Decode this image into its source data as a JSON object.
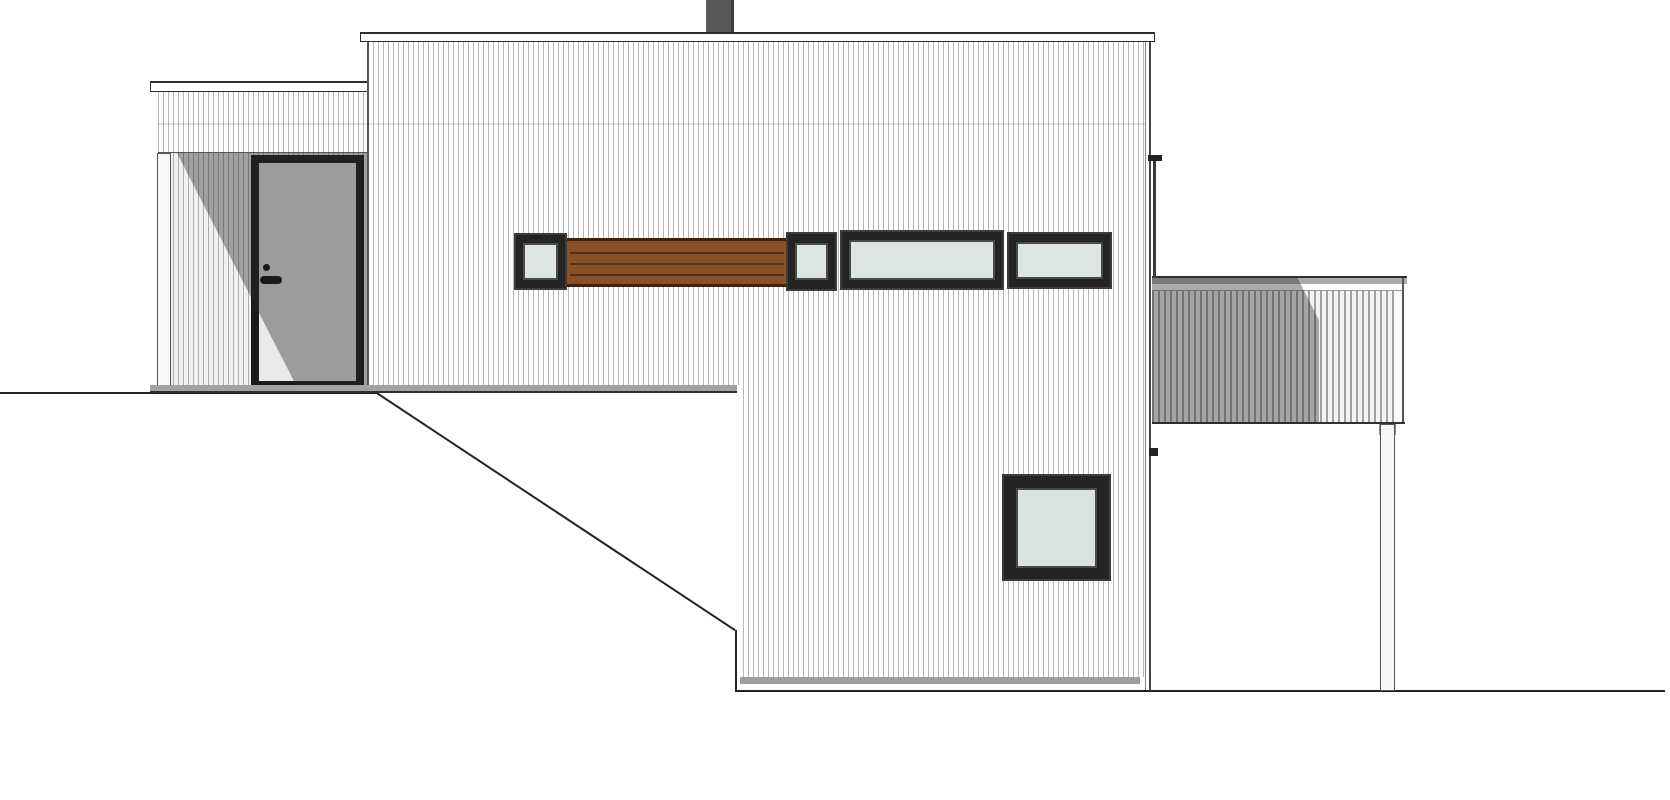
{
  "title": "House side elevation drawing",
  "drawing": {
    "type": "architectural-elevation",
    "view": "side",
    "notes": "split-level house on sloping site; no text or dimensions visible in drawing",
    "colors": {
      "paper": "#ffffff",
      "cladding_white": "#fdfdfd",
      "cladding_stripe": "#b4b4b4",
      "outline_dark": "#222222",
      "frame_black": "#1f1f1f",
      "glass_green": "#dde6e1",
      "wood_brown": "#8b5126",
      "wood_line": "#54311b",
      "door_gray": "#e9e9e9",
      "shadow_overlay": "rgba(40,40,40,0.40)",
      "chimney_gray": "#585858",
      "sill_gray": "#a2a2a2",
      "foundation_gray": "#9e9e9e"
    },
    "parts_inventory": [
      "ground-line",
      "terrain-slope",
      "entry-porch",
      "entry-door",
      "door-handle",
      "porch-post",
      "left-roof-fascia",
      "main-roof-fascia",
      "chimney",
      "window-band-small-window-1",
      "wood-slat-panel",
      "window-band-small-window-2",
      "window-band-wide-window-1",
      "window-band-wide-window-2",
      "lower-square-window",
      "downspout",
      "deck-railing",
      "deck-cap",
      "deck-post",
      "foundation-strip"
    ],
    "elements": [
      {
        "name": "ground-line-upper",
        "cls": "",
        "x": 0,
        "y": 392,
        "w": 378,
        "h": 2,
        "bg": "#222222"
      },
      {
        "name": "terrain-slope-line",
        "cls": "",
        "x": 377,
        "y": 392,
        "w": 430,
        "h": 2,
        "bg": "#222222",
        "rot": 33.5
      },
      {
        "name": "terrain-cut-line",
        "cls": "",
        "x": 735,
        "y": 630,
        "w": 2,
        "h": 62,
        "bg": "#222222"
      },
      {
        "name": "ground-line-lower",
        "cls": "",
        "x": 736,
        "y": 690,
        "w": 929,
        "h": 2,
        "bg": "#222222"
      },
      {
        "name": "porch-siding-band",
        "cls": "stripes",
        "x": 158,
        "y": 92,
        "w": 210,
        "h": 61,
        "bg": "#fcfcfc"
      },
      {
        "name": "porch-ceiling-line",
        "cls": "",
        "x": 158,
        "y": 152,
        "w": 210,
        "h": 1,
        "bg": "#555555"
      },
      {
        "name": "porch-recess-wall",
        "cls": "stripes",
        "x": 158,
        "y": 153,
        "w": 210,
        "h": 234,
        "bg": "#f1f1f1"
      },
      {
        "name": "porch-post",
        "cls": "post",
        "x": 157,
        "y": 153,
        "w": 14,
        "h": 234,
        "bg": "#f7f7f7"
      },
      {
        "name": "entry-door-frame",
        "cls": "",
        "x": 251,
        "y": 155,
        "w": 113,
        "h": 234,
        "bg": "#1b1b1b"
      },
      {
        "name": "entry-door-leaf",
        "cls": "",
        "x": 259,
        "y": 163,
        "w": 97,
        "h": 218,
        "bg": "#e9e9e9"
      },
      {
        "name": "door-peephole",
        "cls": "dot",
        "x": 263,
        "y": 264,
        "w": 7,
        "h": 7,
        "bg": "#111111"
      },
      {
        "name": "door-handle-lever",
        "cls": "lever",
        "x": 260,
        "y": 276,
        "w": 22,
        "h": 8,
        "bg": "#111111"
      },
      {
        "name": "porch-shadow",
        "cls": "",
        "x": 158,
        "y": 153,
        "w": 210,
        "h": 234,
        "bg": "rgba(40,40,40,0.40)",
        "clip": "19px 0px, 210px 0px, 210px 234px, 139px 234px"
      },
      {
        "name": "left-roof-fascia",
        "cls": "fascia",
        "x": 150,
        "y": 81,
        "w": 218,
        "h": 11
      },
      {
        "name": "porch-sill-strip",
        "cls": "sill",
        "x": 150,
        "y": 385,
        "w": 587,
        "h": 8,
        "bg": "#a2a2a2"
      },
      {
        "name": "chimney",
        "cls": "chimney",
        "x": 706,
        "y": 0,
        "w": 28,
        "h": 34,
        "bg": "#585858"
      },
      {
        "name": "main-wall",
        "cls": "stripes",
        "x": 368,
        "y": 42,
        "w": 778,
        "h": 635,
        "bg": "#fdfdfd",
        "clip": "0px 0px, 778px 0px, 778px 635px, 372px 635px, 372px 343px, 0px 343px"
      },
      {
        "name": "main-roof-fascia",
        "cls": "fascia",
        "x": 360,
        "y": 32,
        "w": 795,
        "h": 10
      },
      {
        "name": "main-wall-corner-line",
        "cls": "",
        "x": 367,
        "y": 42,
        "w": 2,
        "h": 343,
        "bg": "#555555"
      },
      {
        "name": "floor-level-shadow-line",
        "cls": "",
        "x": 158,
        "y": 123,
        "w": 988,
        "h": 2,
        "bg": "rgba(0,0,0,0.10)"
      },
      {
        "name": "band-window-1-frame",
        "cls": "winframe",
        "x": 514,
        "y": 233,
        "w": 53,
        "h": 57,
        "bg": "#242424"
      },
      {
        "name": "band-window-1-glass",
        "cls": "glass",
        "x": 523,
        "y": 243,
        "w": 35,
        "h": 37,
        "bg": "#dde6e1"
      },
      {
        "name": "wood-slat-panel",
        "cls": "woodpanel",
        "x": 567,
        "y": 238,
        "w": 219,
        "h": 49,
        "bg": "#8b5126"
      },
      {
        "name": "wood-slat-line-1",
        "cls": "",
        "x": 570,
        "y": 252,
        "w": 214,
        "h": 2,
        "bg": "#54311b"
      },
      {
        "name": "wood-slat-line-2",
        "cls": "",
        "x": 570,
        "y": 263,
        "w": 214,
        "h": 2,
        "bg": "#54311b"
      },
      {
        "name": "wood-slat-line-3",
        "cls": "",
        "x": 570,
        "y": 274,
        "w": 214,
        "h": 2,
        "bg": "#54311b"
      },
      {
        "name": "band-window-2-frame",
        "cls": "winframe",
        "x": 786,
        "y": 232,
        "w": 51,
        "h": 59,
        "bg": "#242424"
      },
      {
        "name": "band-window-2-glass",
        "cls": "glass",
        "x": 795,
        "y": 243,
        "w": 33,
        "h": 37,
        "bg": "#dde6e1"
      },
      {
        "name": "band-window-3-frame",
        "cls": "winframe",
        "x": 840,
        "y": 230,
        "w": 164,
        "h": 60,
        "bg": "#242424"
      },
      {
        "name": "band-window-3-glass",
        "cls": "glass",
        "x": 849,
        "y": 240,
        "w": 146,
        "h": 40,
        "bg": "#dde6e1"
      },
      {
        "name": "band-window-4-frame",
        "cls": "winframe",
        "x": 1007,
        "y": 232,
        "w": 105,
        "h": 57,
        "bg": "#242424"
      },
      {
        "name": "band-window-4-glass",
        "cls": "glass",
        "x": 1016,
        "y": 242,
        "w": 87,
        "h": 37,
        "bg": "#dde6e1"
      },
      {
        "name": "lower-window-frame",
        "cls": "winframe",
        "x": 1002,
        "y": 474,
        "w": 109,
        "h": 107,
        "bg": "#242424"
      },
      {
        "name": "lower-window-glass",
        "cls": "glass",
        "x": 1016,
        "y": 488,
        "w": 81,
        "h": 80,
        "bg": "#d9e3de"
      },
      {
        "name": "foundation-strip",
        "cls": "",
        "x": 740,
        "y": 677,
        "w": 400,
        "h": 7,
        "bg": "#9e9e9e"
      },
      {
        "name": "deck-cap-top-line",
        "cls": "",
        "x": 1152,
        "y": 276,
        "w": 255,
        "h": 2,
        "bg": "#2e2e2e"
      },
      {
        "name": "deck-cap-top-face",
        "cls": "",
        "x": 1152,
        "y": 278,
        "w": 255,
        "h": 6,
        "bg": "#ababab"
      },
      {
        "name": "deck-cap-front",
        "cls": "",
        "x": 1152,
        "y": 284,
        "w": 255,
        "h": 7,
        "bg": "#fdfdfd"
      },
      {
        "name": "deck-cap-bottom-line",
        "cls": "",
        "x": 1152,
        "y": 290,
        "w": 252,
        "h": 1,
        "bg": "#9a9a9a"
      },
      {
        "name": "deck-railing-slats",
        "cls": "stripes2",
        "x": 1152,
        "y": 291,
        "w": 242,
        "h": 132,
        "bg": "#f3f3f3"
      },
      {
        "name": "deck-railing-end-board",
        "cls": "",
        "x": 1394,
        "y": 291,
        "w": 9,
        "h": 132,
        "bg": "#fafafa"
      },
      {
        "name": "deck-railing-right-edge",
        "cls": "",
        "x": 1402,
        "y": 278,
        "w": 2,
        "h": 146,
        "bg": "#555555"
      },
      {
        "name": "deck-railing-bottom-line",
        "cls": "",
        "x": 1152,
        "y": 422,
        "w": 253,
        "h": 2,
        "bg": "#333333"
      },
      {
        "name": "deck-shadow",
        "cls": "",
        "x": 1152,
        "y": 277,
        "w": 167,
        "h": 147,
        "bg": "rgba(40,40,40,0.38)",
        "clip": "0px 0px, 145px 0px, 167px 43px, 167px 147px, 0px 147px"
      },
      {
        "name": "deck-post-head",
        "cls": "",
        "x": 1379,
        "y": 424,
        "w": 17,
        "h": 11,
        "bg": "#8c8c8c"
      },
      {
        "name": "deck-post",
        "cls": "post",
        "x": 1380,
        "y": 424,
        "w": 15,
        "h": 267,
        "bg": "#f6f6f6"
      },
      {
        "name": "main-wall-right-corner-line-inner",
        "cls": "",
        "x": 1145,
        "y": 42,
        "w": 1,
        "h": 648,
        "bg": "#888888"
      },
      {
        "name": "main-wall-right-corner-line",
        "cls": "",
        "x": 1149,
        "y": 42,
        "w": 2,
        "h": 649,
        "bg": "#444444"
      },
      {
        "name": "downspout-bracket-upper",
        "cls": "",
        "x": 1148,
        "y": 155,
        "w": 14,
        "h": 6,
        "bg": "#222222"
      },
      {
        "name": "downspout-pipe",
        "cls": "",
        "x": 1153,
        "y": 161,
        "w": 3,
        "h": 117,
        "bg": "#3a3a3a"
      },
      {
        "name": "downspout-bracket-lower",
        "cls": "",
        "x": 1149,
        "y": 448,
        "w": 9,
        "h": 8,
        "bg": "#222222"
      }
    ]
  }
}
